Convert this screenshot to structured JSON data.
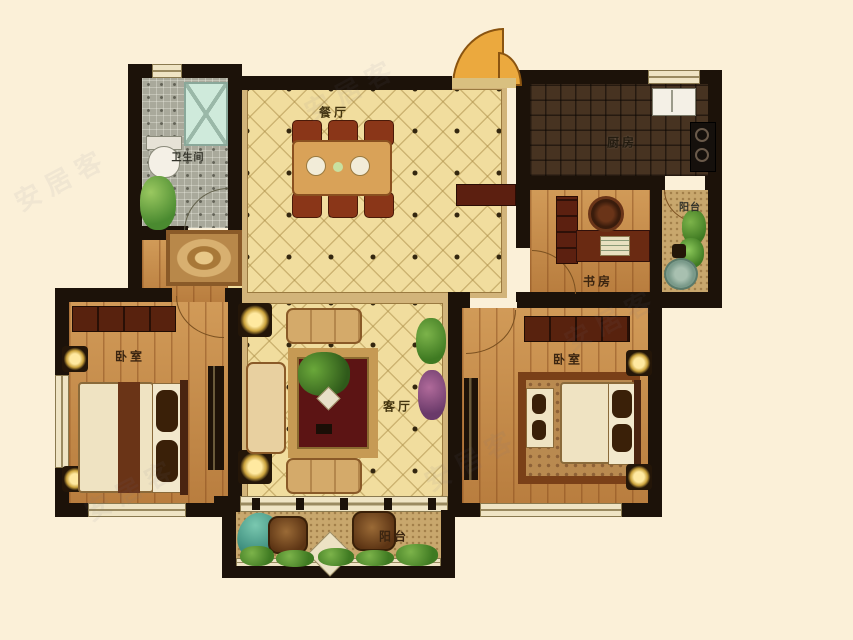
{
  "rooms": {
    "dining": {
      "label": "餐厅"
    },
    "living": {
      "label": "客厅"
    },
    "kitchen": {
      "label": "厨房"
    },
    "bathroom": {
      "label": "卫生间"
    },
    "study": {
      "label": "书房"
    },
    "bedroom_left": {
      "label": "卧室"
    },
    "bedroom_right": {
      "label": "卧室"
    },
    "balcony_right": {
      "label": "阳台"
    },
    "balcony_bottom": {
      "label": "阳台"
    }
  },
  "watermark": {
    "text": "安居客"
  },
  "colors": {
    "wall": "#1c1209",
    "floor_main": "#f1dd9e",
    "floor_wood": "#c78c48",
    "floor_kitchen": "#473321",
    "floor_mosaic": "#a9a99b",
    "floor_balcony": "#c8a76d",
    "door_fan": "#eba93e",
    "background": "#fbf0d8"
  }
}
